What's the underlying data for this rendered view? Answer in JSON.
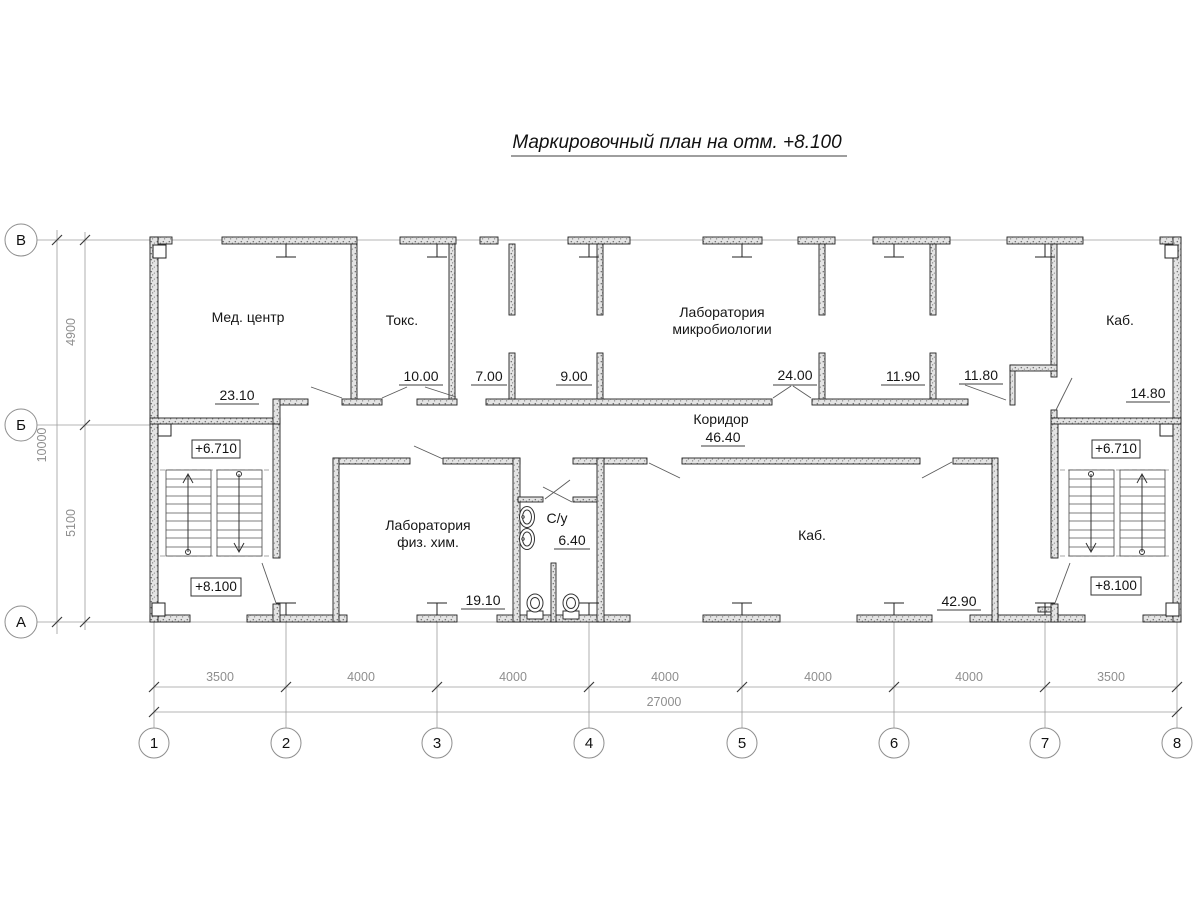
{
  "title": "Маркировочный план на отм. +8.100",
  "axes": {
    "rows": [
      "В",
      "Б",
      "А"
    ],
    "cols": [
      "1",
      "2",
      "3",
      "4",
      "5",
      "6",
      "7",
      "8"
    ]
  },
  "dims": {
    "left_segments": [
      "4900",
      "5100"
    ],
    "left_total": "10000",
    "bottom_segments": [
      "3500",
      "4000",
      "4000",
      "4000",
      "4000",
      "4000",
      "3500"
    ],
    "bottom_total": "27000"
  },
  "rooms": {
    "med_center": {
      "name": "Мед. центр",
      "area": "23.10"
    },
    "toks": {
      "name": "Токс.",
      "area": "10.00"
    },
    "room_7": {
      "area": "7.00"
    },
    "room_9": {
      "area": "9.00"
    },
    "microbiology": {
      "name_line1": "Лаборатория",
      "name_line2": "микробиологии",
      "area": "24.00"
    },
    "room_1190": {
      "area": "11.90"
    },
    "room_1180": {
      "area": "11.80"
    },
    "kab_right_top": {
      "name": "Каб.",
      "area": "14.80"
    },
    "corridor": {
      "name": "Коридор",
      "area": "46.40"
    },
    "fizhim": {
      "name_line1": "Лаборатория",
      "name_line2": "физ. хим.",
      "area": "19.10"
    },
    "sanuzel": {
      "name": "С/у",
      "area": "6.40"
    },
    "kab_big": {
      "name": "Каб.",
      "area": "42.90"
    }
  },
  "elevations": {
    "left_upper": "+6.710",
    "left_lower": "+8.100",
    "right_upper": "+6.710",
    "right_lower": "+8.100"
  },
  "colors": {
    "wall_stroke": "#222222",
    "dim_gray": "#8e8e8e",
    "text_black": "#161616"
  }
}
